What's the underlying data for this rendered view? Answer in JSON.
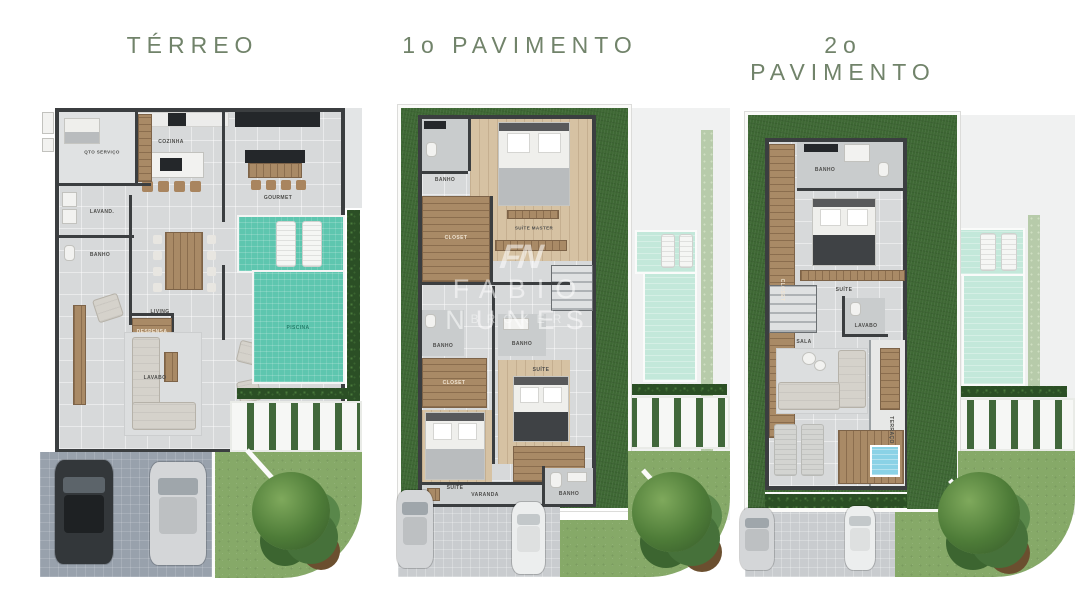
{
  "titles": {
    "plan1": "TÉRREO",
    "plan2": "1o PAVIMENTO",
    "plan3": "2o PAVIMENTO"
  },
  "watermark": {
    "monogram": "FN",
    "name": "FABIO NUNES",
    "role": "BROKER"
  },
  "palette": {
    "title_green": "#71836a",
    "wall_dark": "#3b3e40",
    "floor_gray": "#d7d9da",
    "wood": "#a98a66",
    "pool_teal": "#5ec6af",
    "pool_faded": "#c3e8da",
    "grass_dark": "#3e6834",
    "garden_green": "#86a968",
    "hedge_green": "#2b4f25",
    "paver_gray": "#98a1ac"
  },
  "plan1": {
    "labels": {
      "servico": "QTO SERVIÇO",
      "cozinha": "COZINHA",
      "gourmet": "GOURMET",
      "lavanderia": "LAVAND.",
      "banho": "BANHO",
      "despensa": "DESPENSA",
      "lavabo": "LAVABO",
      "living": "LIVING",
      "piscina": "PISCINA"
    }
  },
  "plan2": {
    "labels": {
      "banho": "BANHO",
      "suite_master": "SUÍTE MASTER",
      "closet": "CLOSET",
      "suite": "SUÍTE",
      "varanda": "VARANDA"
    }
  },
  "plan3": {
    "labels": {
      "banho": "BANHO",
      "closet": "CLOSET",
      "suite": "SUÍTE",
      "lavabo": "LAVABO",
      "sala": "SALA",
      "terraco": "TERRAÇO"
    }
  }
}
